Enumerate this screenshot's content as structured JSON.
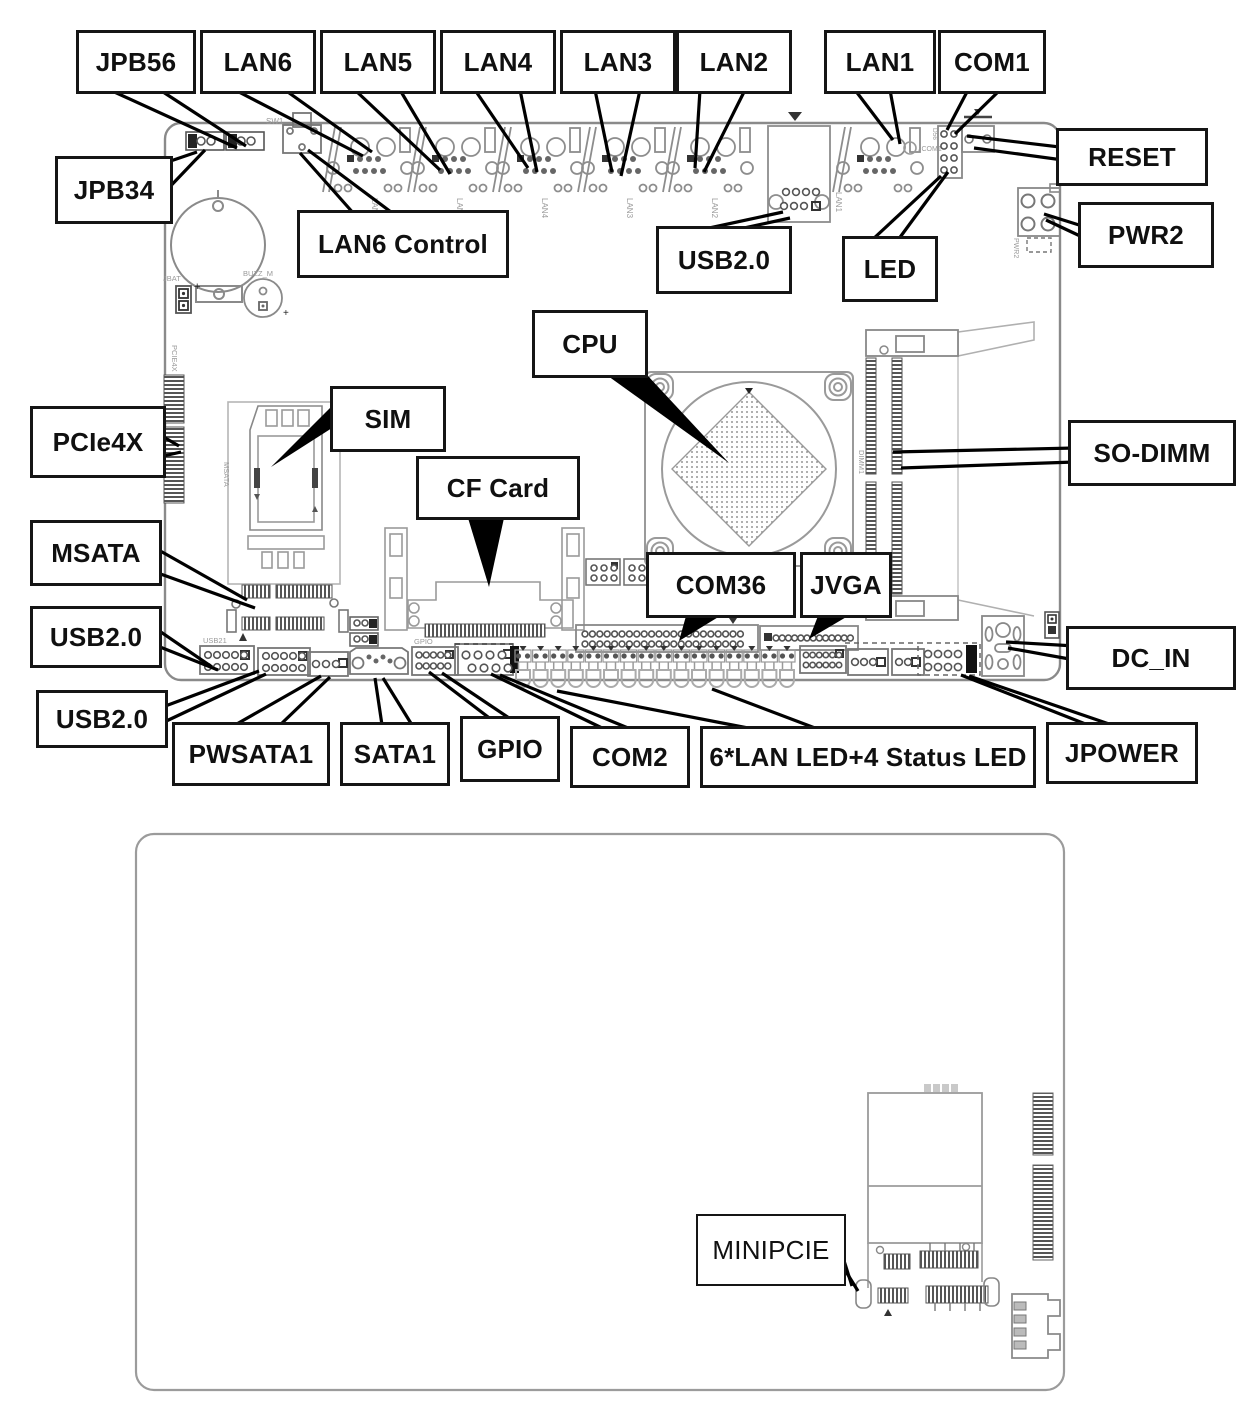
{
  "page": {
    "background": "#ffffff",
    "leader_line_color": "#000000",
    "board_outline_color": "#8a8a8a"
  },
  "labels": {
    "jpb56": "JPB56",
    "jpb34": "JPB34",
    "lan6": "LAN6",
    "lan5": "LAN5",
    "lan4": "LAN4",
    "lan3": "LAN3",
    "lan2": "LAN2",
    "lan1": "LAN1",
    "com1": "COM1",
    "reset": "RESET",
    "lan6_control": "LAN6 Control",
    "usb20_top": "USB2.0",
    "led": "LED",
    "pwr2": "PWR2",
    "cpu": "CPU",
    "pcie4x": "PCIe4X",
    "sim": "SIM",
    "sodimm": "SO-DIMM",
    "cf_card": "CF Card",
    "msata": "MSATA",
    "com36": "COM36",
    "jvga": "JVGA",
    "usb20_left_upper": "USB2.0",
    "usb20_left_lower": "USB2.0",
    "dc_in": "DC_IN",
    "pwsata1": "PWSATA1",
    "sata1": "SATA1",
    "gpio": "GPIO",
    "com2": "COM2",
    "lan_status_led": "6*LAN LED+4 Status LED",
    "jpower": "JPOWER",
    "minipcie": "MINIPCIE"
  },
  "silkscreen": {
    "sw1": "SW1",
    "jbat": "JBAT",
    "buzzer": "BUZZ_M",
    "battery_plus": "+",
    "buzzer_plus": "+",
    "pcie4x": "PCIE4X",
    "msata": "MSATA",
    "usb21": "USB21",
    "gpio": "GPIO",
    "jcom1": "JCOM1",
    "d56": "D56",
    "pwr2": "PWR2",
    "dimm1": "DIMM1",
    "lan6": "LAN6",
    "lan5": "LAN5",
    "lan4": "LAN4",
    "lan3": "LAN3",
    "lan2": "LAN2",
    "lan1": "LAN1"
  }
}
